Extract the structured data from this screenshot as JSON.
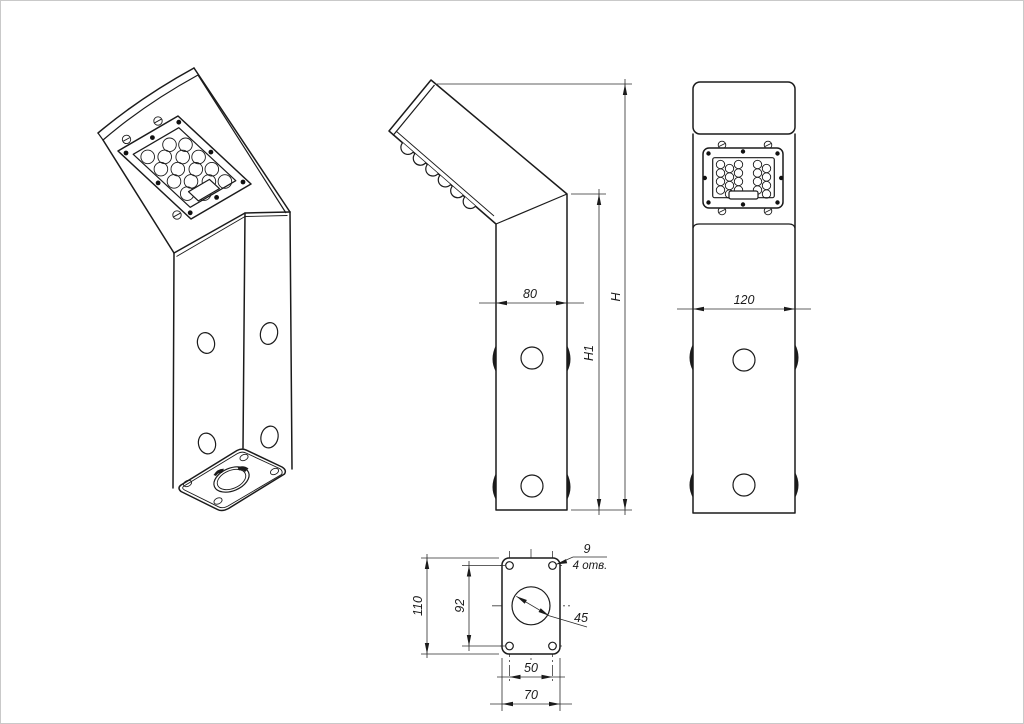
{
  "page": {
    "background": "#ffffff",
    "border_color": "#c9c9c9",
    "line_color": "#1b1b1b"
  },
  "drawing": {
    "type": "technical-drawing",
    "subject": "angled LED bollard luminaire, orthographic projections",
    "views": {
      "isometric": {
        "label": "isometric-view"
      },
      "side": {
        "label": "side-view",
        "dims": {
          "depth": "80",
          "height_total": "H",
          "height_column": "H1"
        }
      },
      "front": {
        "label": "front-view",
        "dims": {
          "width": "120"
        }
      },
      "bottom": {
        "label": "bottom-flange-view",
        "dims": {
          "plate_length": "110",
          "hole_pitch_length": "92",
          "hole_pitch_width": "50",
          "plate_width": "70",
          "center_hole_diameter": "45",
          "mount_hole_diameter": "9",
          "mount_hole_count": "4 отв."
        }
      }
    }
  }
}
